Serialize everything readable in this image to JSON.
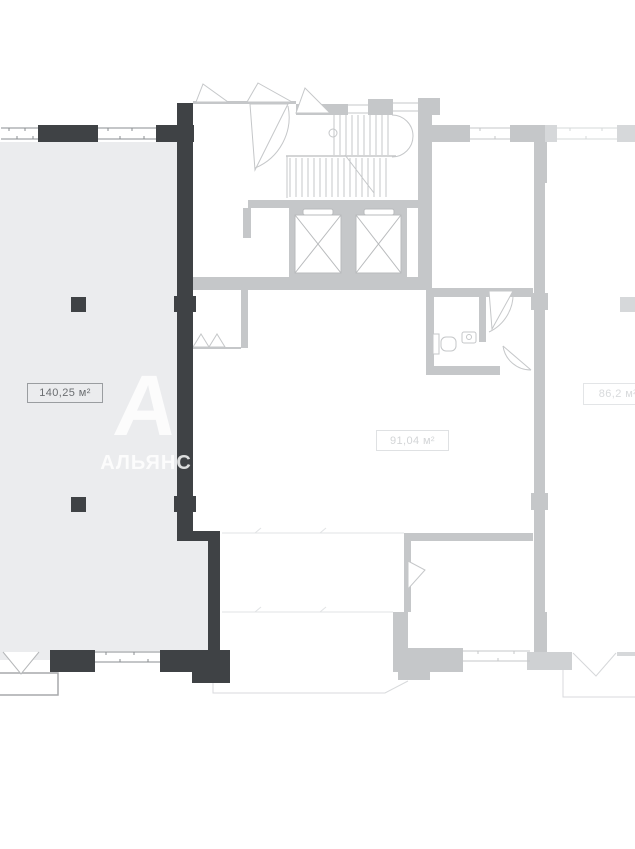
{
  "floorplan": {
    "units": [
      {
        "id": "unit-140",
        "area_label": "140,25 м²",
        "highlighted": true
      },
      {
        "id": "unit-91",
        "area_label": "91,04 м²",
        "highlighted": false
      },
      {
        "id": "unit-86",
        "area_label": "86,2 м²",
        "highlighted": false
      }
    ],
    "watermark": {
      "logo": "А",
      "text": "АЛЬЯНС"
    },
    "colors": {
      "highlight_wall": "#3f4245",
      "highlight_fill": "#ebecee",
      "core_wall": "#c5c7c9",
      "light_wall": "#d6d8da",
      "faint_line": "#dcdee0",
      "background": "#ffffff"
    }
  }
}
